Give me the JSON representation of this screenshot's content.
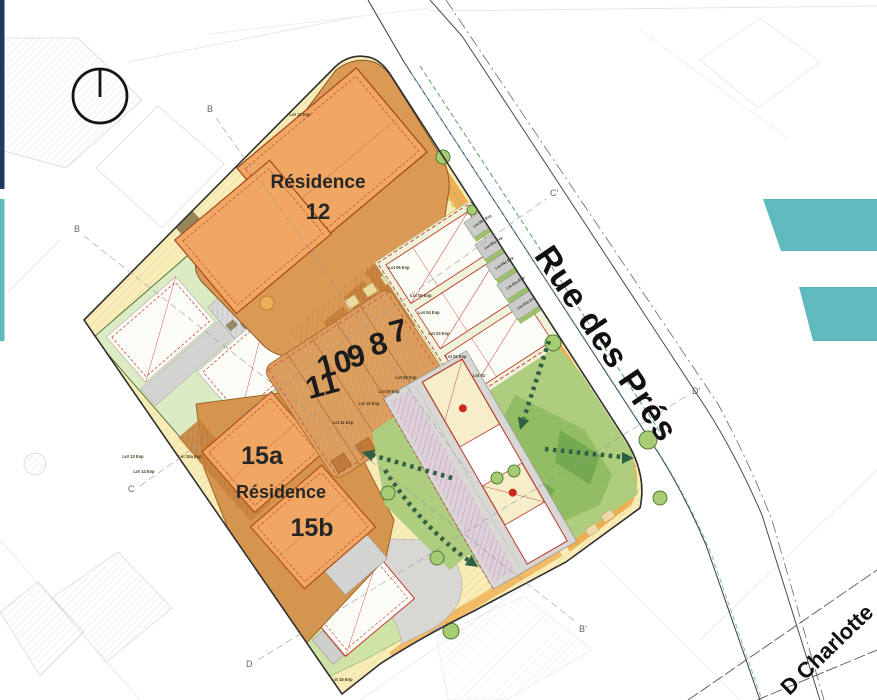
{
  "plan": {
    "residence12": {
      "name": "Résidence",
      "number": "12"
    },
    "residence15": {
      "a": "15a",
      "name": "Résidence",
      "b": "15b"
    },
    "plot_numbers": [
      "7",
      "8",
      "9",
      "10",
      "11"
    ],
    "streets": {
      "main": "Rue des Prés",
      "secondary": "D Charlotte"
    },
    "markers": {
      "b_top": "B",
      "b_left": "B",
      "b_prime": "B'",
      "c": "C",
      "c_prime": "C'",
      "d": "D",
      "d_prime": "D'"
    },
    "lots": [
      {
        "text": "Lot 12 Evp"
      },
      {
        "text": "Lot 06 Evp"
      },
      {
        "text": "Lot 05 Evp"
      },
      {
        "text": "Lot 04 Evp"
      },
      {
        "text": "Lot 03 Evp"
      },
      {
        "text": "Lot 02 Evp"
      },
      {
        "text": "Lot 01"
      },
      {
        "text": "Lot 08 Evp"
      },
      {
        "text": "Lot 09 Evp"
      },
      {
        "text": "Lot 10 Evp"
      },
      {
        "text": "Lot 11 Evp"
      },
      {
        "text": "Lot 13 Evp"
      },
      {
        "text": "Lot 14 Evp"
      },
      {
        "text": "Lot 15a Evp"
      },
      {
        "text": "Lot 15 Evp"
      },
      {
        "text": "Lot 06a Evp"
      },
      {
        "text": "Lot 05a Evp"
      },
      {
        "text": "Lot 04a Evp"
      },
      {
        "text": "Lot 03a Evp"
      },
      {
        "text": "Lot 02a Evp"
      }
    ],
    "icons": {
      "north": "north-indicator"
    }
  },
  "colors": {
    "navy_bar": "#1d3a60",
    "teal_accent": "#5fb9bd",
    "site_yellow": "#f8edb9",
    "street_band_orange": "#f0ae53",
    "residence_zone_orange": "#d6954f",
    "building_orange": "#efa763",
    "rows_zone_orange": "#dc9f60",
    "lawn_green": "#aecd7f",
    "light_green": "#dcebc3",
    "parking_gray": "#d8d7d3",
    "outline_red": "#c0392b",
    "arrow_green": "#2f5f46"
  }
}
